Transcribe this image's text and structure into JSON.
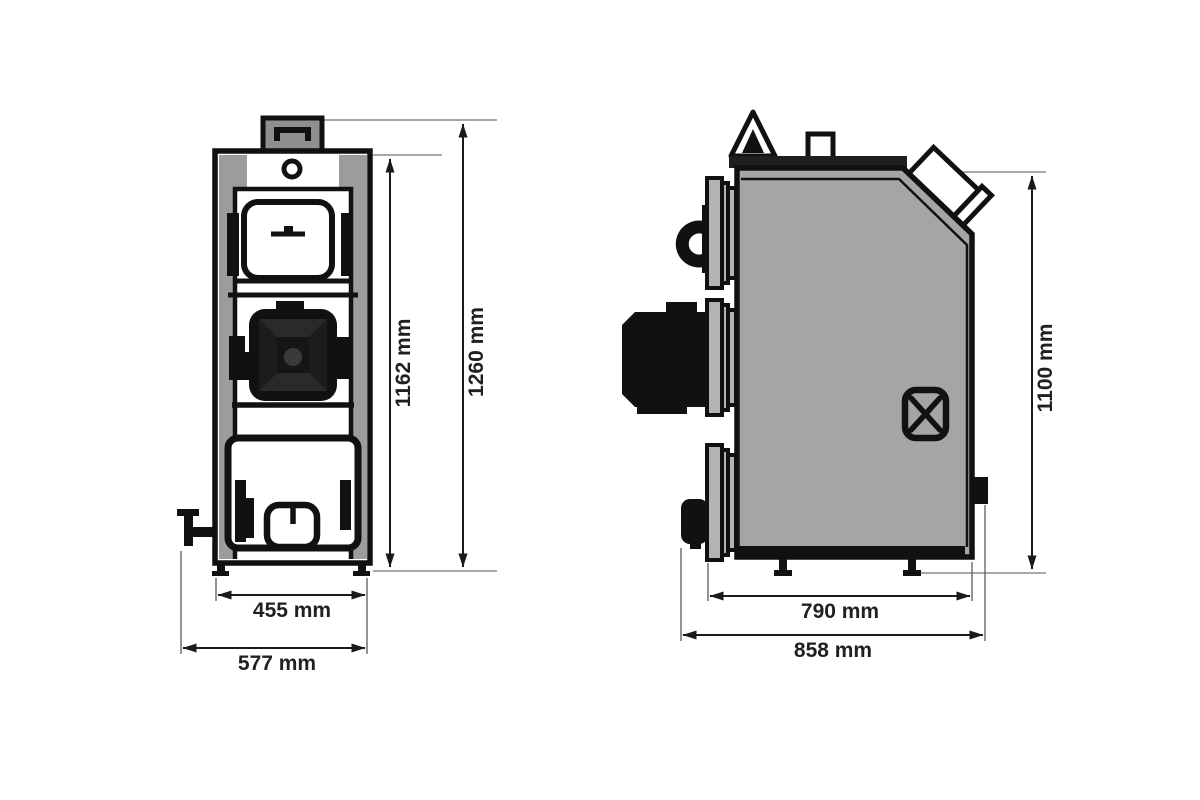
{
  "drawing": {
    "type": "technical-dimension-drawing",
    "subject": "solid-fuel-boiler",
    "units": "mm",
    "colors": {
      "background": "#ffffff",
      "line": "#111111",
      "body_fill": "#a5a5a5",
      "panel_fill": "#9c9c9c",
      "chimney_fill": "#8f8f8f",
      "flange_fill": "#b3b3b3",
      "dark_fill": "#111111",
      "bevel_fill": "#2a2a2a",
      "dim_line": "#1a1a1a",
      "extension_line": "#8c8c8c",
      "label_text": "#231f20"
    },
    "views": {
      "front": {
        "name": "front-view",
        "dimensions": {
          "body_height": {
            "text": "1162 mm",
            "orientation": "vertical"
          },
          "total_height": {
            "text": "1260 mm",
            "orientation": "vertical"
          },
          "body_width": {
            "text": "455 mm",
            "orientation": "horizontal"
          },
          "total_width": {
            "text": "577 mm",
            "orientation": "horizontal"
          }
        }
      },
      "side": {
        "name": "side-view",
        "dimensions": {
          "height": {
            "text": "1100 mm",
            "orientation": "vertical"
          },
          "body_depth": {
            "text": "790 mm",
            "orientation": "horizontal"
          },
          "total_depth": {
            "text": "858 mm",
            "orientation": "horizontal"
          }
        }
      }
    }
  }
}
